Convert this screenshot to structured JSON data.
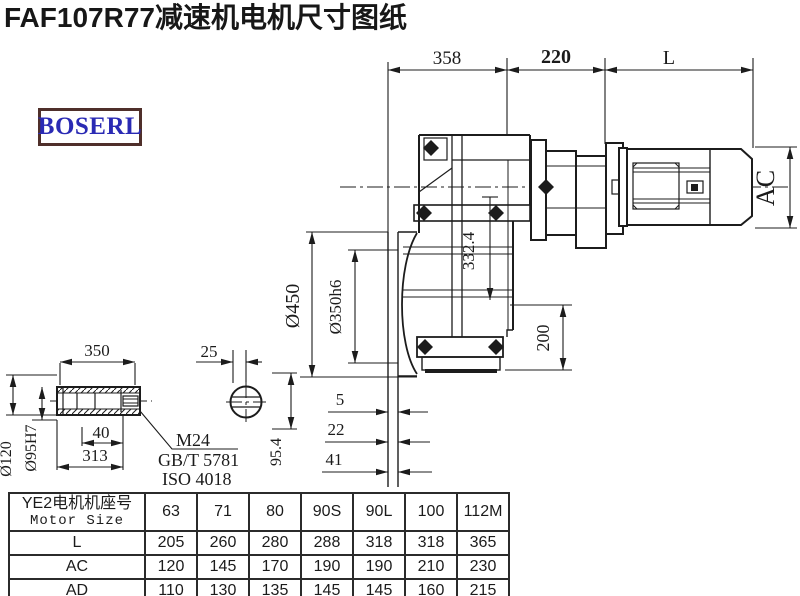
{
  "title": "FAF107R77减速机电机尺寸图纸",
  "logo": "BOSERL",
  "dims": {
    "top_358": "358",
    "top_220": "220",
    "top_L": "L",
    "ac": "AC",
    "h332": "332.4",
    "d450": "Ø450",
    "d350": "Ø350h6",
    "d200": "200",
    "g5": "5",
    "g22": "22",
    "g41": "41",
    "s350": "350",
    "s25": "25",
    "s40": "40",
    "s313": "313",
    "m24": "M24",
    "gbt": "GB/T 5781",
    "iso": "ISO 4018",
    "d120": "Ø120",
    "d95": "Ø95H7",
    "v954": "95.4"
  },
  "table": {
    "header_cn": "YE2电机机座号",
    "header_en": "Motor Size",
    "columns": [
      "63",
      "71",
      "80",
      "90S",
      "90L",
      "100",
      "112M"
    ],
    "rows": [
      {
        "label": "L",
        "values": [
          "205",
          "260",
          "280",
          "288",
          "318",
          "318",
          "365"
        ]
      },
      {
        "label": "AC",
        "values": [
          "120",
          "145",
          "170",
          "190",
          "190",
          "210",
          "230"
        ]
      },
      {
        "label": "AD",
        "values": [
          "110",
          "130",
          "135",
          "145",
          "145",
          "160",
          "215"
        ]
      }
    ]
  },
  "colors": {
    "line": "#1c1c1c",
    "logo_border": "#4f2f2a",
    "logo_text": "#2a2ab4"
  }
}
